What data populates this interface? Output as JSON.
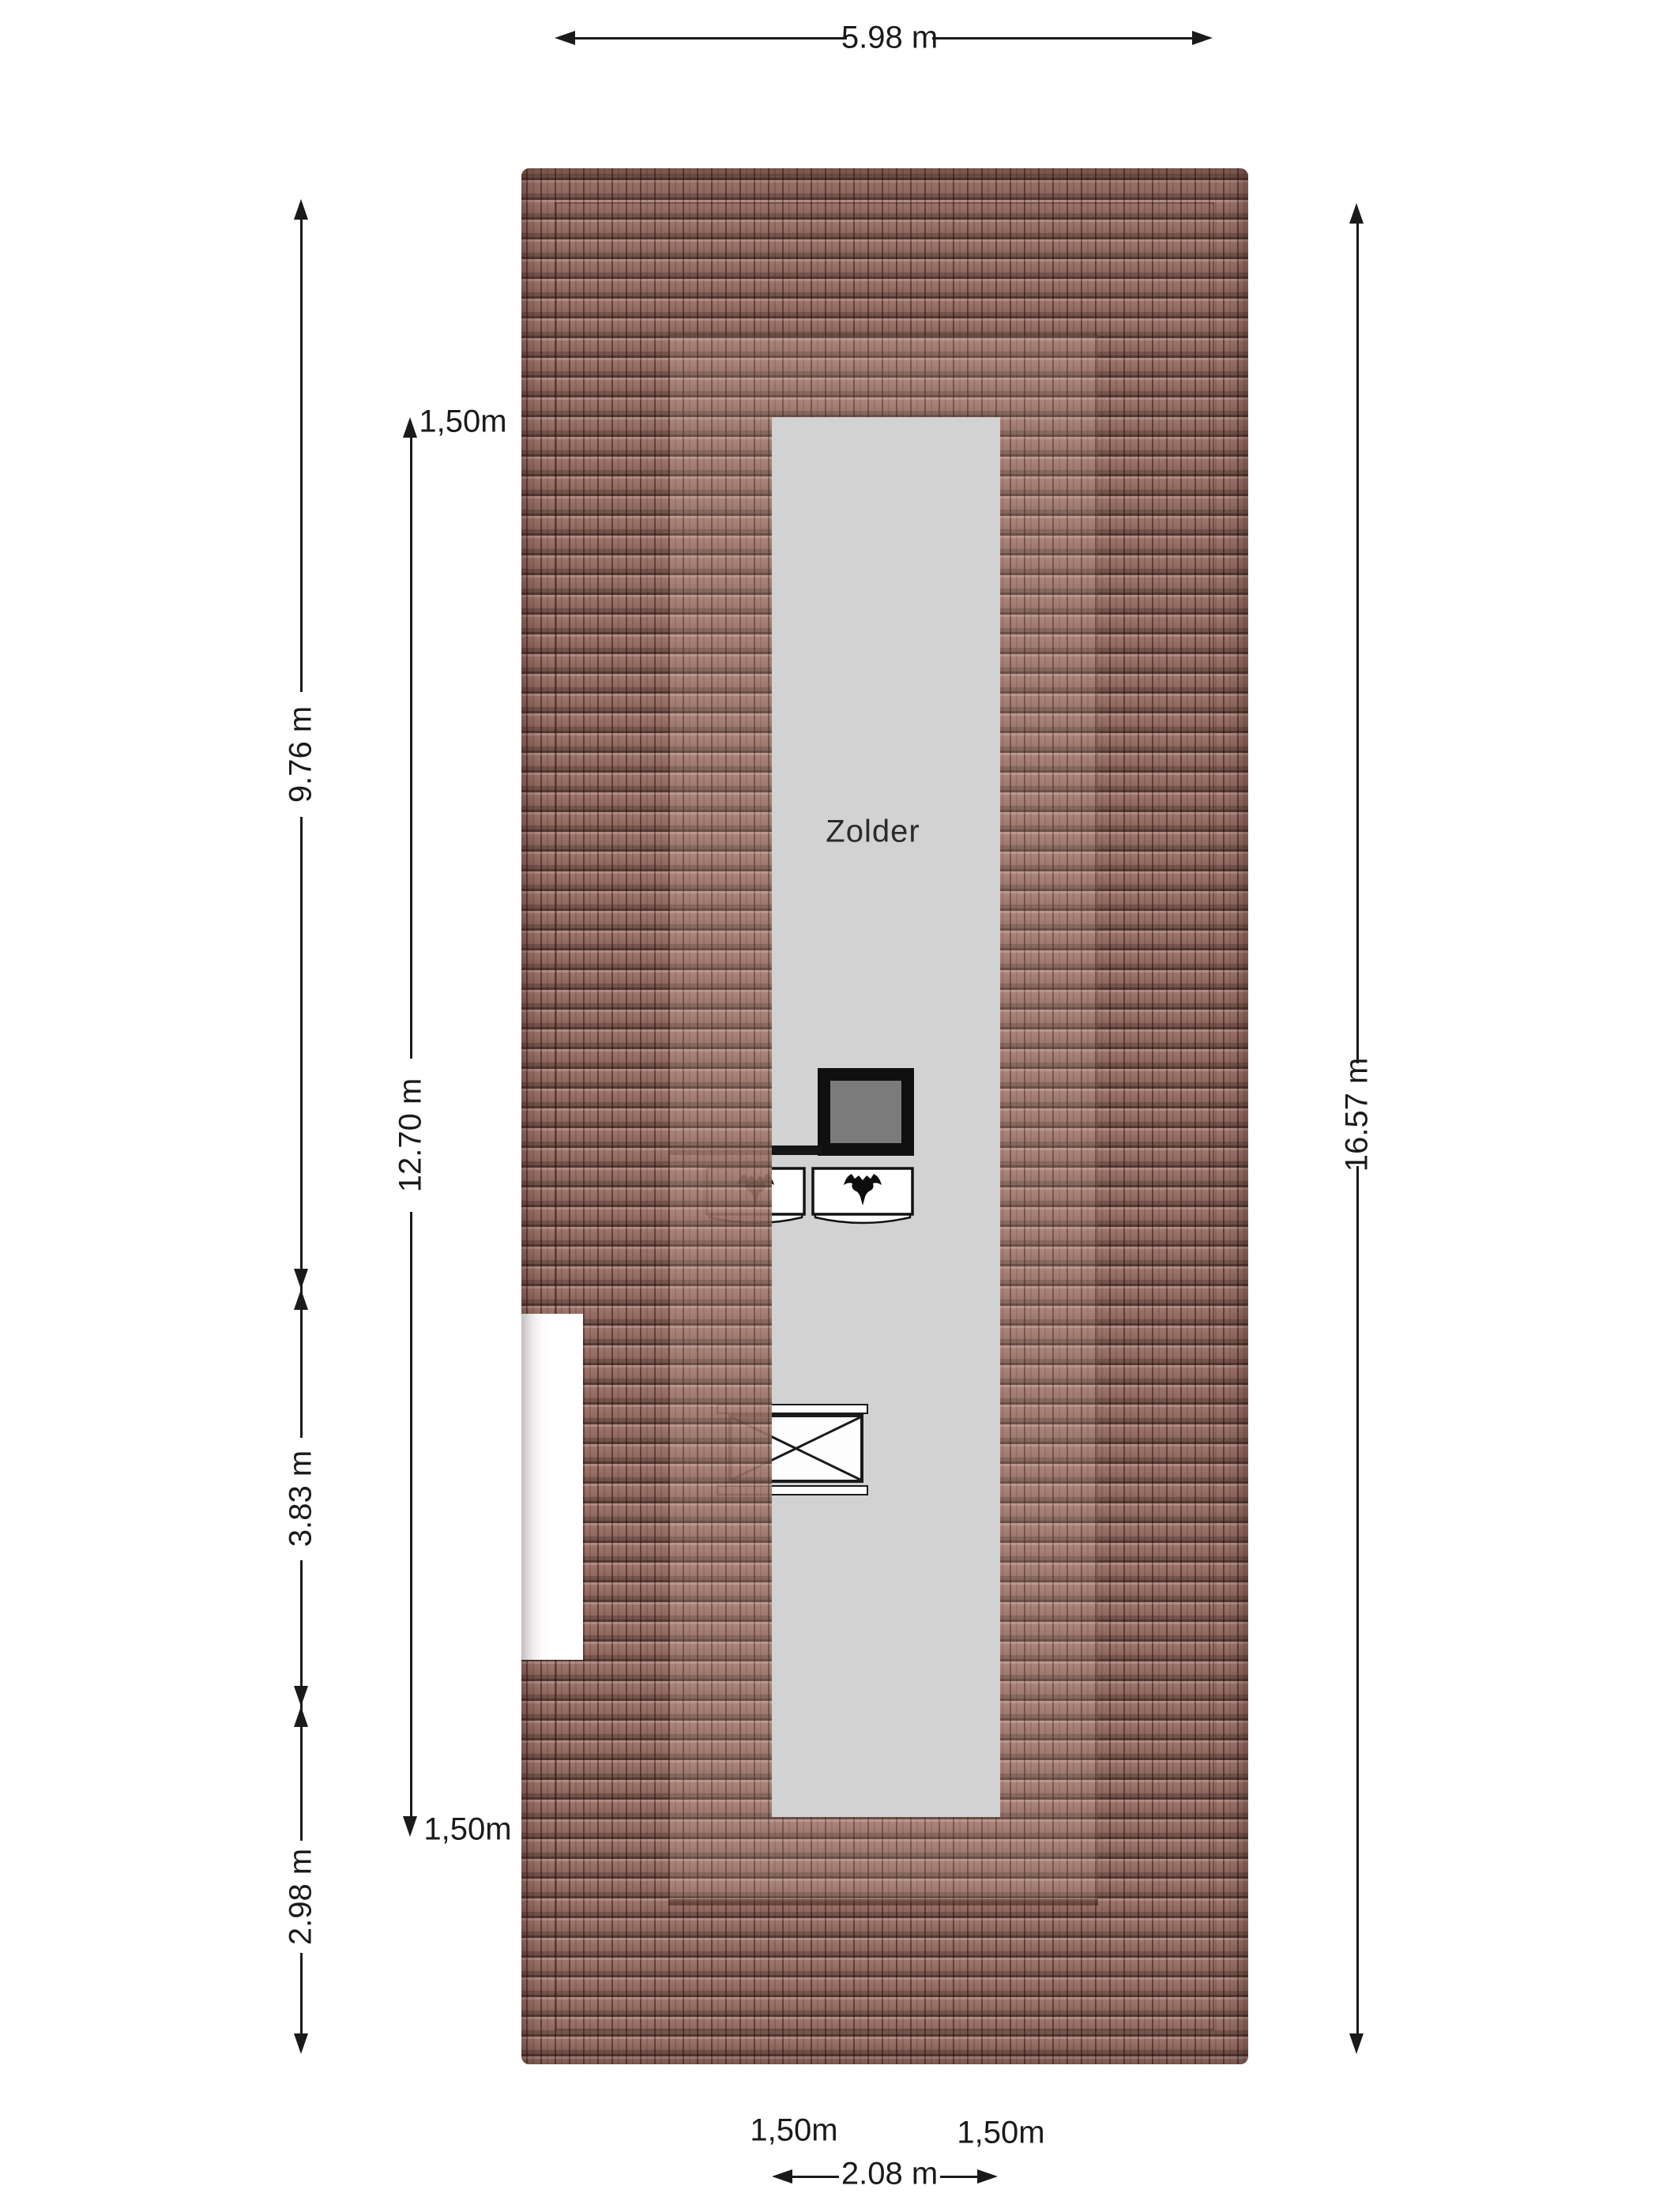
{
  "room": {
    "label": "Zolder"
  },
  "dimensions": {
    "top_width": "5.98 m",
    "right_height": "16.57 m",
    "left_outer": {
      "upper": "9.76 m",
      "middle": "3.83 m",
      "lower": "2.98 m"
    },
    "left_inner": {
      "top_offset": "1,50m",
      "length": "12.70 m",
      "bottom_offset": "1,50m"
    },
    "bottom": {
      "left_offset": "1,50m",
      "right_offset": "1,50m",
      "width": "2.08 m"
    }
  },
  "colors": {
    "roof_tile_base": "#9a7065",
    "roof_tile_line": "#2e1a13",
    "attic_floor": "#d2d2d2",
    "chimney_frame": "#101010",
    "chimney_flue": "#7b7b7b",
    "dimension_ink": "#1a1a1a"
  },
  "icons": {
    "roof_window_icon": "bat-silhouette",
    "stair_opening_icon": "x-cross"
  }
}
